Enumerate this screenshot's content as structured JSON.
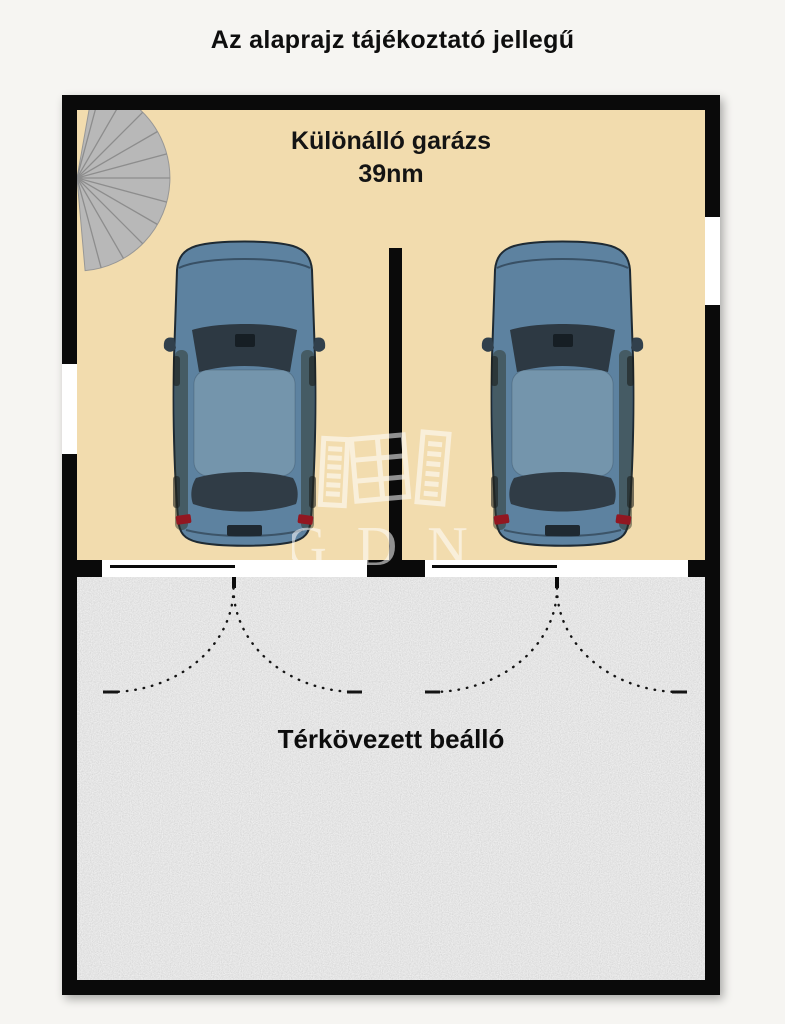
{
  "title": "Az alaprajz tájékoztató jellegű",
  "garage": {
    "name_line1": "Különálló garázs",
    "name_line2": "39nm",
    "floor_color": "#f2dcae",
    "wall_color": "#0a0a0a",
    "cars": {
      "count": 2,
      "body_color": "#5d82a0",
      "roof_color": "#7495ac",
      "glass_color": "#2d3943",
      "taillight_color": "#921721"
    },
    "staircase_color": "#b8b8b8"
  },
  "carport": {
    "label": "Térkövezett beálló",
    "floor_color": "#c6c6c6"
  },
  "watermark": {
    "text": "GDN"
  }
}
